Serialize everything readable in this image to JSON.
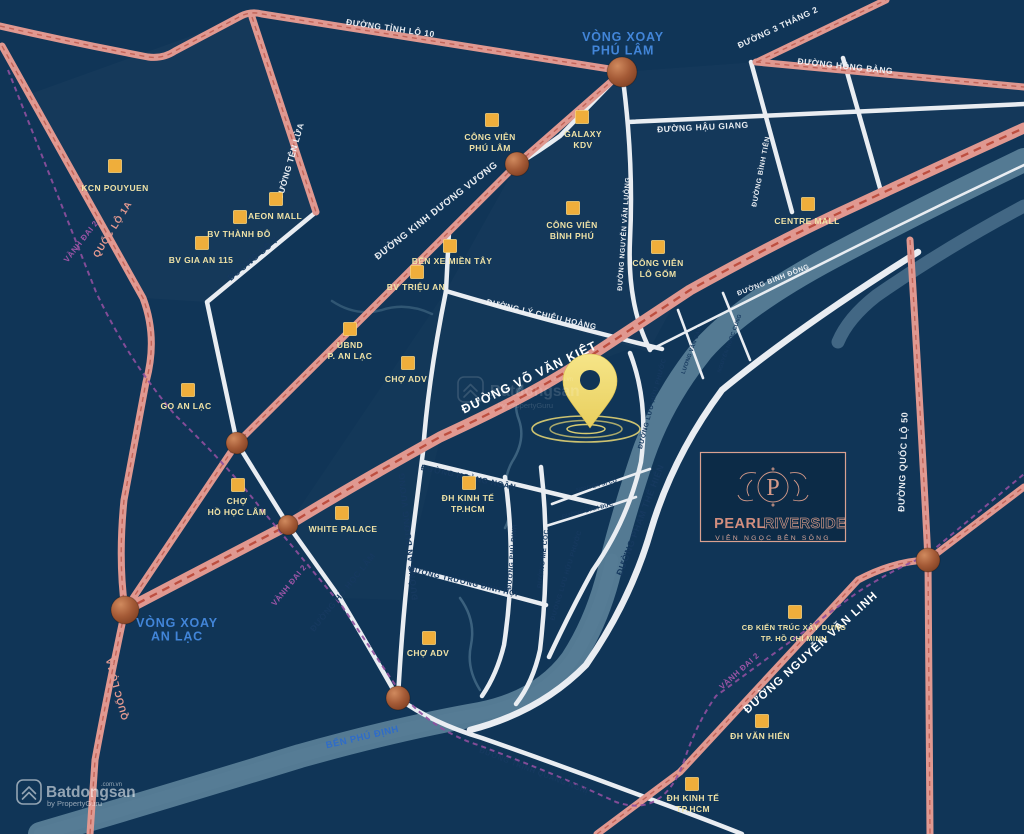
{
  "project": {
    "monogram": "P",
    "name_primary": "PEARL",
    "name_secondary": "RIVERSIDE",
    "tagline": "VIÊN NGỌC BÊN SÔNG"
  },
  "watermark": {
    "brand": "Batdongsan",
    "domain": ".com.vn",
    "byline": "by PropertyGuru"
  },
  "colors": {
    "background_navy": "#103557",
    "road_pink": "#E09890",
    "road_pink_dash": "#C2655A",
    "road_white": "#E9EDF2",
    "water_teal": "#587E97",
    "ring_road_purple": "#8F4F9F",
    "poi_gold": "#EFAE3B",
    "poi_label": "#EFE2A6",
    "roundabout_blue": "#4285D8",
    "brand_rose": "#D29486",
    "pin_yellow": "#F3DF76"
  },
  "roundabouts": [
    {
      "lines": [
        "VÒNG XOAY",
        "PHÚ LÂM"
      ],
      "x": 623,
      "y": 41
    },
    {
      "lines": [
        "VÒNG XOAY",
        "AN LẠC"
      ],
      "x": 177,
      "y": 627
    }
  ],
  "road_labels": [
    {
      "text": "ĐƯỜNG TỈNH LỘ 10",
      "x": 390,
      "y": 31,
      "rot": 8,
      "cls": "w",
      "size": 8.5
    },
    {
      "text": "ĐƯỜNG 3 THÁNG 2",
      "x": 779,
      "y": 30,
      "rot": -25,
      "cls": "w",
      "size": 8.5
    },
    {
      "text": "ĐƯỜNG HỒNG BÀNG",
      "x": 845,
      "y": 69,
      "rot": 6,
      "cls": "w",
      "size": 8.5
    },
    {
      "text": "ĐƯỜNG HẬU GIANG",
      "x": 703,
      "y": 130,
      "rot": -3,
      "cls": "w",
      "size": 8.5
    },
    {
      "text": "ĐƯỜNG TÊN LỬA",
      "x": 293,
      "y": 162,
      "rot": -74,
      "cls": "w",
      "size": 8.5
    },
    {
      "text": "QUỐC LỘ 1A",
      "x": 115,
      "y": 231,
      "rot": -58,
      "cls": "p",
      "size": 9.5
    },
    {
      "text": "VÀNH ĐAI 2",
      "x": 83,
      "y": 243,
      "rot": -52,
      "cls": "v",
      "size": 8
    },
    {
      "text": "ĐƯỜNG KINH DƯƠNG VƯƠNG",
      "x": 438,
      "y": 213,
      "rot": -38,
      "cls": "w",
      "size": 9.5
    },
    {
      "text": "ĐƯỜNG SỐ 7",
      "x": 255,
      "y": 261,
      "rot": -40,
      "cls": "d",
      "size": 9
    },
    {
      "text": "ĐƯỜNG NGUYỄN VĂN LUÔNG",
      "x": 626,
      "y": 234,
      "rot": -86,
      "cls": "w",
      "size": 7
    },
    {
      "text": "ĐƯỜNG BÌNH TIÊN",
      "x": 763,
      "y": 172,
      "rot": -79,
      "cls": "w",
      "size": 7
    },
    {
      "text": "ĐƯỜNG LÝ CHIÊU HOÀNG",
      "x": 541,
      "y": 317,
      "rot": 13,
      "cls": "w",
      "size": 8
    },
    {
      "text": "ĐƯỜNG VÕ VĂN KIỆT",
      "x": 531,
      "y": 381,
      "rot": -26,
      "cls": "wb",
      "size": 12.5
    },
    {
      "text": "ĐƯỜNG BÌNH ĐÔNG",
      "x": 774,
      "y": 282,
      "rot": -21,
      "cls": "w",
      "size": 7
    },
    {
      "text": "ĐƯỜNG HỒ HỌC LÂM",
      "x": 345,
      "y": 594,
      "rot": -51,
      "cls": "d",
      "size": 8.5
    },
    {
      "text": "VÀNH ĐAI 2",
      "x": 291,
      "y": 587,
      "rot": -51,
      "cls": "v",
      "size": 8
    },
    {
      "text": "QUỐC LỘ 1A",
      "x": 120,
      "y": 688,
      "rot": -105,
      "cls": "p",
      "size": 9.5
    },
    {
      "text": "ĐƯỜNG AN DƯƠNG VƯƠNG",
      "x": 411,
      "y": 536,
      "rot": -96,
      "cls": "d",
      "size": 8.5
    },
    {
      "text": "ĐƯỜNG HOÀNG NGÂN",
      "x": 468,
      "y": 480,
      "rot": 12,
      "cls": "d",
      "size": 8
    },
    {
      "text": "ĐƯỜNG TRƯƠNG ĐÌNH HỘI",
      "x": 463,
      "y": 584,
      "rot": 13,
      "cls": "d",
      "size": 7.5
    },
    {
      "text": "ĐƯỜNG PHÚ ĐỊNH",
      "x": 514,
      "y": 557,
      "rot": -85,
      "cls": "d",
      "size": 6.5
    },
    {
      "text": "ĐƯỜNG MỄ CỐC",
      "x": 545,
      "y": 559,
      "rot": -83,
      "cls": "d",
      "size": 6.5
    },
    {
      "text": "ĐƯỜNG LƯU HỮU PHƯỚC",
      "x": 654,
      "y": 404,
      "rot": -75,
      "cls": "d",
      "size": 6.5
    },
    {
      "text": "ĐƯỜNG LƯU HỮU PHƯỚC",
      "x": 568,
      "y": 576,
      "rot": -73,
      "cls": "d",
      "size": 6.5
    },
    {
      "text": "ĐƯỜNG PHẠM THẾ HIỂN",
      "x": 643,
      "y": 521,
      "rot": -69,
      "cls": "d",
      "size": 9
    },
    {
      "text": "ĐƯỜNG TRỊNH QUANG NGHỊ",
      "x": 533,
      "y": 773,
      "rot": 21,
      "cls": "d",
      "size": 7.5
    },
    {
      "text": "ĐƯỜNG NGUYỄN VĂN LINH",
      "x": 813,
      "y": 655,
      "rot": -42,
      "cls": "wb",
      "size": 11.5
    },
    {
      "text": "VÀNH ĐAI 2",
      "x": 741,
      "y": 673,
      "rot": -42,
      "cls": "v",
      "size": 8
    },
    {
      "text": "ĐƯỜNG QUỐC LỘ 50",
      "x": 906,
      "y": 462,
      "rot": -88,
      "cls": "w",
      "size": 9
    },
    {
      "text": "BẾN PHÚ ĐỊNH",
      "x": 363,
      "y": 740,
      "rot": -13,
      "cls": "b",
      "size": 9.5
    },
    {
      "text": "NGUYỄN SĨ CỐ",
      "x": 597,
      "y": 487,
      "rot": -14,
      "cls": "d",
      "size": 5.5
    },
    {
      "text": "ĐƯỜNG BÌNH ĐỨC",
      "x": 588,
      "y": 512,
      "rot": -14,
      "cls": "d",
      "size": 5.5
    },
    {
      "text": "LƯƠNG VĂN CAN",
      "x": 693,
      "y": 351,
      "rot": -70,
      "cls": "d",
      "size": 5.5
    },
    {
      "text": "NGUYỄN NGỌC CUNG",
      "x": 731,
      "y": 344,
      "rot": -70,
      "cls": "d",
      "size": 5.5
    }
  ],
  "pois": [
    {
      "lines": [
        "KCN POUYUEN"
      ],
      "mx": 115,
      "my": 166,
      "lx": 115,
      "ly": 191
    },
    {
      "lines": [
        "AEON MALL"
      ],
      "mx": 276,
      "my": 199,
      "lx": 275,
      "ly": 219
    },
    {
      "lines": [
        "BV THÀNH ĐÔ"
      ],
      "mx": 240,
      "my": 217,
      "lx": 239,
      "ly": 237
    },
    {
      "lines": [
        "BV GIA AN 115"
      ],
      "mx": 202,
      "my": 243,
      "lx": 201,
      "ly": 263
    },
    {
      "lines": [
        "CÔNG VIÊN",
        "PHÚ LÂM"
      ],
      "mx": 492,
      "my": 120,
      "lx": 490,
      "ly": 140
    },
    {
      "lines": [
        "GALAXY",
        "KDV"
      ],
      "mx": 582,
      "my": 117,
      "lx": 583,
      "ly": 137
    },
    {
      "lines": [
        "CÔNG VIÊN",
        "BÌNH PHÚ"
      ],
      "mx": 573,
      "my": 208,
      "lx": 572,
      "ly": 228
    },
    {
      "lines": [
        "CÔNG VIÊN",
        "LÔ GỐM"
      ],
      "mx": 658,
      "my": 247,
      "lx": 658,
      "ly": 266
    },
    {
      "lines": [
        "CENTRE MALL"
      ],
      "mx": 808,
      "my": 204,
      "lx": 807,
      "ly": 224
    },
    {
      "lines": [
        "BẾN XE MIỀN TÂY"
      ],
      "mx": 450,
      "my": 246,
      "lx": 452,
      "ly": 264
    },
    {
      "lines": [
        "BV TRIỆU AN"
      ],
      "mx": 417,
      "my": 272,
      "lx": 416,
      "ly": 290
    },
    {
      "lines": [
        "UBND",
        "P. AN LẠC"
      ],
      "mx": 350,
      "my": 329,
      "lx": 350,
      "ly": 348
    },
    {
      "lines": [
        "CHỢ ADV"
      ],
      "mx": 408,
      "my": 363,
      "lx": 406,
      "ly": 382
    },
    {
      "lines": [
        "GO AN LẠC"
      ],
      "mx": 188,
      "my": 390,
      "lx": 186,
      "ly": 409
    },
    {
      "lines": [
        "CHỢ",
        "HỒ HỌC LÂM"
      ],
      "mx": 238,
      "my": 485,
      "lx": 237,
      "ly": 504
    },
    {
      "lines": [
        "WHITE PALACE"
      ],
      "mx": 342,
      "my": 513,
      "lx": 343,
      "ly": 532
    },
    {
      "lines": [
        "ĐH KINH TẾ",
        "TP.HCM"
      ],
      "mx": 469,
      "my": 483,
      "lx": 468,
      "ly": 501
    },
    {
      "lines": [
        "CHỢ ADV"
      ],
      "mx": 429,
      "my": 638,
      "lx": 428,
      "ly": 656
    },
    {
      "lines": [
        "CĐ KIẾN TRÚC XÂY DỰNG",
        "TP. HỒ CHÍ MINH"
      ],
      "mx": 795,
      "my": 612,
      "lx": 794,
      "ly": 630,
      "size": 7.5
    },
    {
      "lines": [
        "ĐH VĂN HIẾN"
      ],
      "mx": 762,
      "my": 721,
      "lx": 760,
      "ly": 739
    },
    {
      "lines": [
        "ĐH KINH TẾ",
        "TP.HCM"
      ],
      "mx": 692,
      "my": 784,
      "lx": 693,
      "ly": 801
    }
  ]
}
